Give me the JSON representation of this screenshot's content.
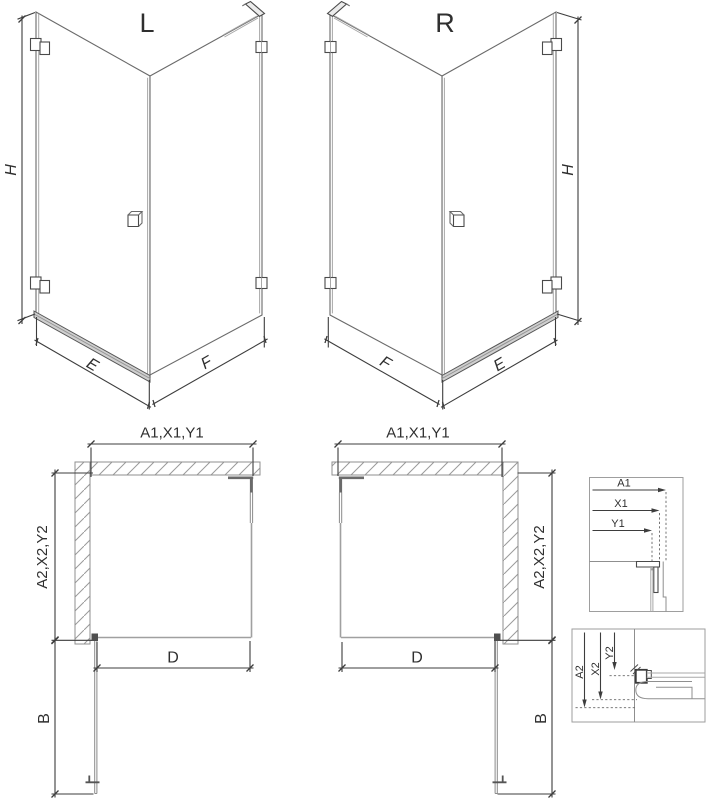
{
  "drawing": {
    "kind": "shower-enclosure technical drawing, left and right variants",
    "colors": {
      "background": "#ffffff",
      "dimension_line": "#3d3d3d",
      "glass_line": "#a0a0a0",
      "wall_hatch": "#9a9a9a",
      "text": "#2f2f2f"
    }
  },
  "iso_left": {
    "title": "L",
    "dim_h": "H",
    "dim_e": "E",
    "dim_f": "F"
  },
  "iso_right": {
    "title": "R",
    "dim_h": "H",
    "dim_f": "F",
    "dim_e": "E"
  },
  "plan_left": {
    "dim_top": "A1,X1,Y1",
    "dim_side": "A2,X2,Y2",
    "dim_d": "D",
    "dim_b": "B"
  },
  "plan_right": {
    "dim_top": "A1,X1,Y1",
    "dim_side": "A2,X2,Y2",
    "dim_d": "D",
    "dim_b": "B"
  },
  "detail_top": {
    "dims": [
      "A1",
      "X1",
      "Y1"
    ]
  },
  "detail_bottom": {
    "dims": [
      "A2",
      "X2",
      "Y2"
    ]
  }
}
